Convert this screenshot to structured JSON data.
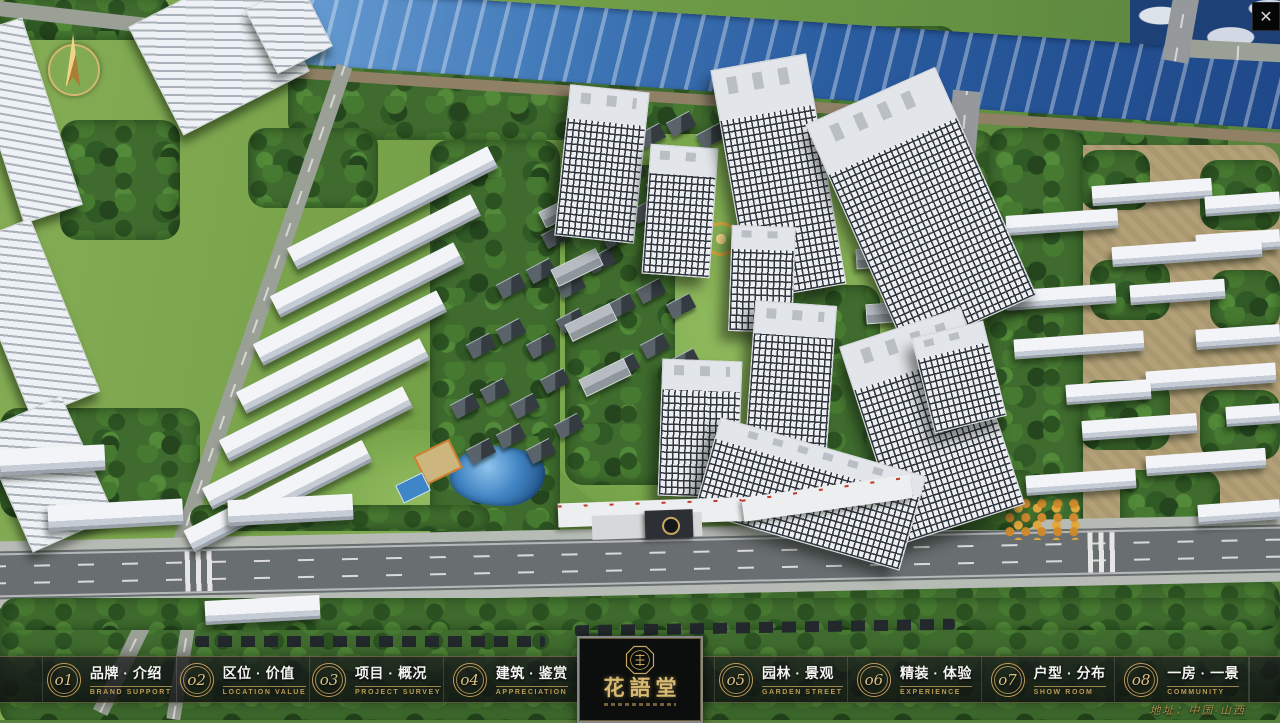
{
  "viewport": {
    "close_label": "✕"
  },
  "nav": {
    "items": [
      {
        "num": "o1",
        "title": "品牌 · 介绍",
        "sub": "BRAND SUPPORT"
      },
      {
        "num": "o2",
        "title": "区位 · 价值",
        "sub": "LOCATION VALUE"
      },
      {
        "num": "o3",
        "title": "项目 · 概况",
        "sub": "PROJECT SURVEY"
      },
      {
        "num": "o4",
        "title": "建筑 · 鉴赏",
        "sub": "APPRECIATION"
      },
      {
        "num": "o5",
        "title": "园林 · 景观",
        "sub": "GARDEN STREET"
      },
      {
        "num": "o6",
        "title": "精装 · 体验",
        "sub": "EXPERIENCE"
      },
      {
        "num": "o7",
        "title": "户型 · 分布",
        "sub": "SHOW ROOM"
      },
      {
        "num": "o8",
        "title": "一房 · 一景",
        "sub": "COMMUNITY"
      }
    ]
  },
  "logo": {
    "title": "花語堂"
  },
  "footer": {
    "address": "地址：中国·山西"
  }
}
